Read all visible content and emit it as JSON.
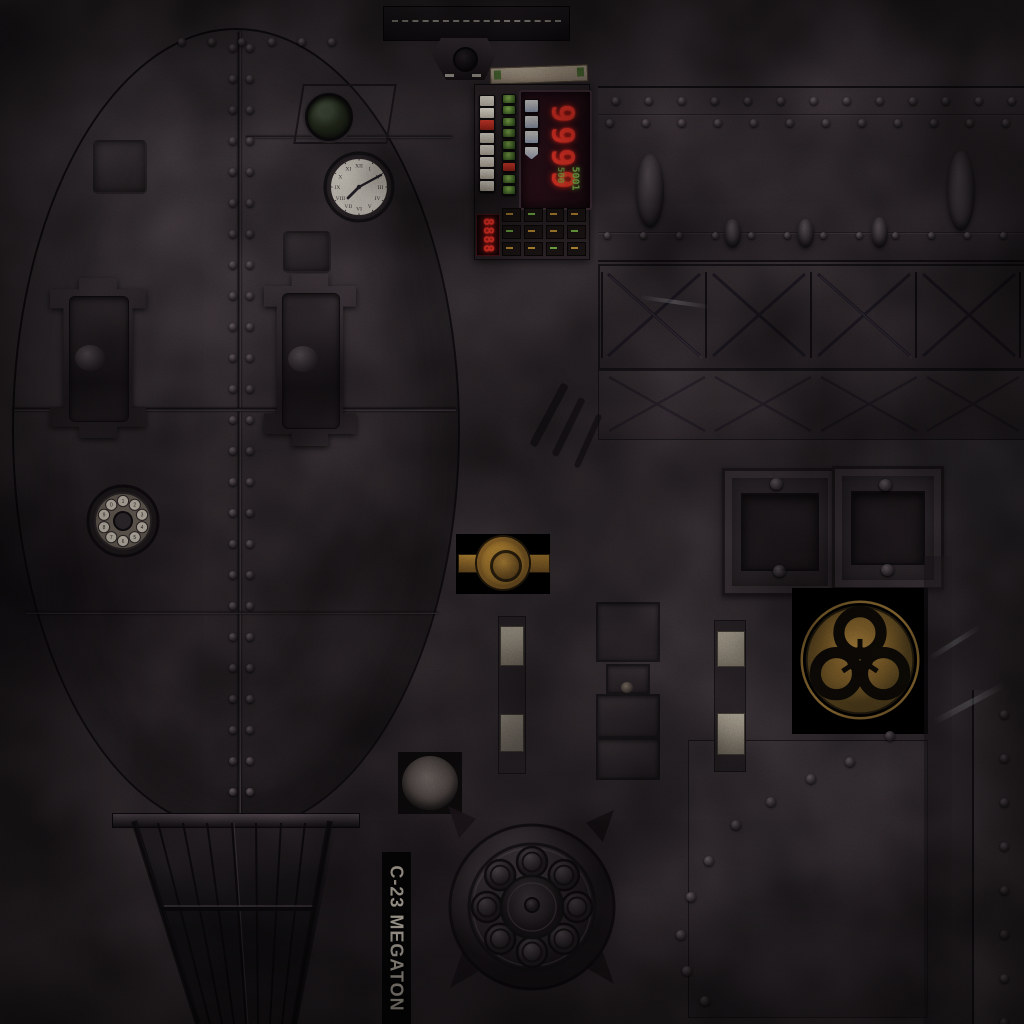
{
  "atlas": {
    "stencil_label": "C-23 MEGATON",
    "control_panel": {
      "main_display": "9999",
      "sub_display": "8888",
      "aux_displays": [
        "500",
        "5001"
      ]
    },
    "clock": {
      "numerals": [
        "XII",
        "I",
        "II",
        "III",
        "IV",
        "V",
        "VI",
        "VII",
        "VIII",
        "IX",
        "X",
        "XI"
      ]
    },
    "rotary_dial": {
      "digits": [
        "1",
        "2",
        "3",
        "4",
        "5",
        "6",
        "7",
        "8",
        "9",
        "0"
      ]
    },
    "emblem": {
      "name": "biohazard"
    },
    "colors": {
      "display_red": "#ff3527",
      "led_green": "#6fae3f",
      "button_white": "#ded9cb",
      "button_red": "#c03224",
      "brass": "#8d6828",
      "emblem_gold": "#8a6a30",
      "clock_face": "#d8d2c4",
      "label_text": "#aaa395"
    }
  }
}
